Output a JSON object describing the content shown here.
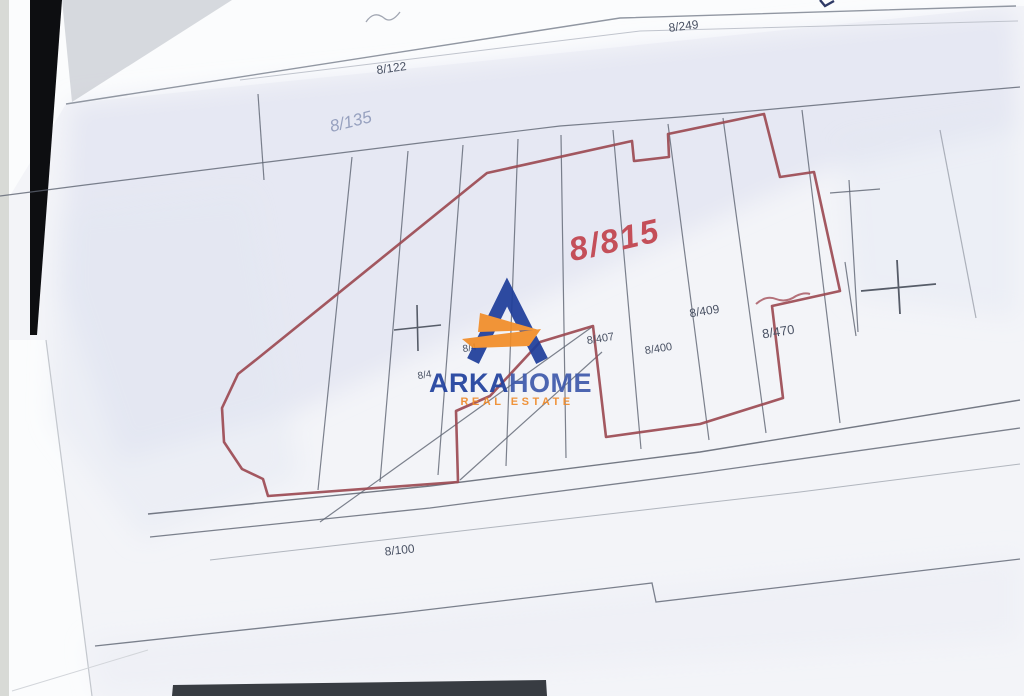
{
  "map": {
    "highlighted_parcel_label": "8/815",
    "boundary_color": "#9c4a52",
    "red_label_color": "#c44f59",
    "line_color": "#5d6370",
    "labels": [
      {
        "text": "8/249"
      },
      {
        "text": "8/122"
      },
      {
        "text": "8/135"
      },
      {
        "text": "8/815"
      },
      {
        "text": "8/407"
      },
      {
        "text": "8/400"
      },
      {
        "text": "8/409"
      },
      {
        "text": "8/470"
      },
      {
        "text": "8/4"
      },
      {
        "text": "8/4"
      },
      {
        "text": "8/100"
      }
    ]
  },
  "watermark": {
    "brand_primary": "ARKA",
    "brand_secondary": "HOME",
    "tagline": "REAL ESTATE",
    "navy_color": "#1f3e9b",
    "orange_color": "#f28d27"
  }
}
